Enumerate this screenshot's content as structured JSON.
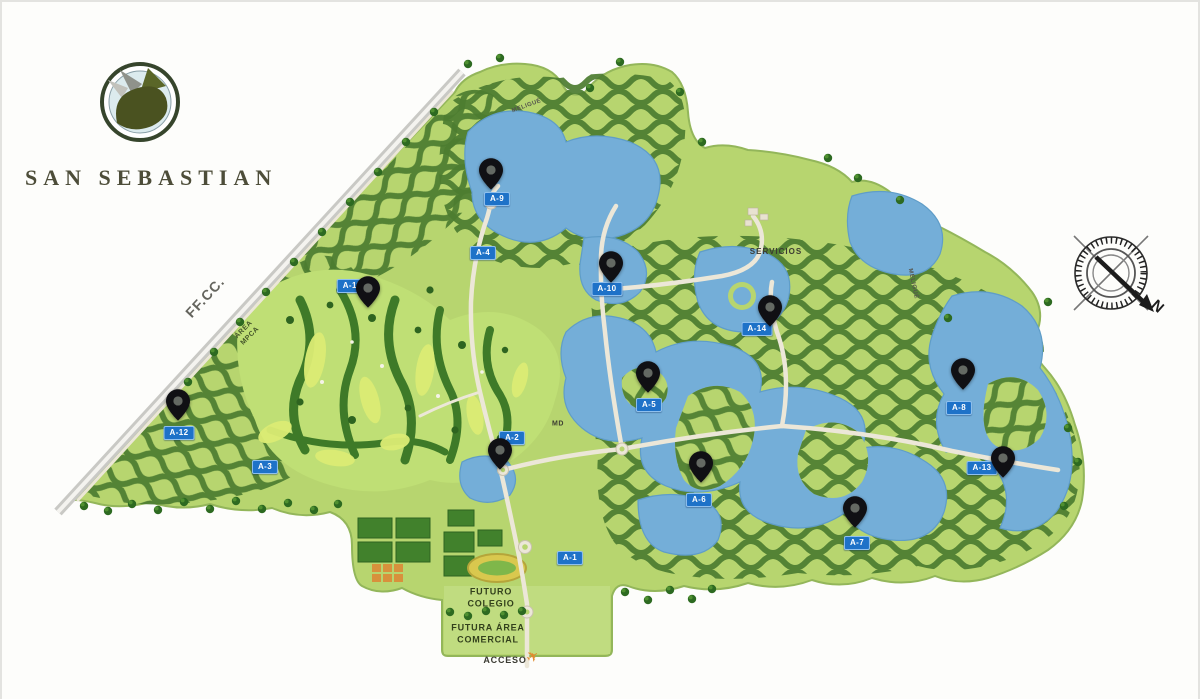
{
  "branding": {
    "title": "SAN SEBASTIAN"
  },
  "compass": {
    "north_label": "N"
  },
  "map": {
    "colors": {
      "label_bg": "#1e72c8",
      "water": "#74aed8",
      "base_green": "#b7d56f",
      "residential_green": "#4c7c30",
      "pin_color": "#101014",
      "road": "#ece7d8"
    },
    "area_labels": [
      {
        "id": "A-9",
        "text": "A-9",
        "x": 497,
        "y": 199
      },
      {
        "id": "A-4",
        "text": "A-4",
        "x": 483,
        "y": 253
      },
      {
        "id": "A-11",
        "text": "A-11",
        "x": 352,
        "y": 286
      },
      {
        "id": "A-10",
        "text": "A-10",
        "x": 607,
        "y": 289
      },
      {
        "id": "A-14",
        "text": "A-14",
        "x": 757,
        "y": 329
      },
      {
        "id": "A-5",
        "text": "A-5",
        "x": 649,
        "y": 405
      },
      {
        "id": "A-12",
        "text": "A-12",
        "x": 179,
        "y": 433
      },
      {
        "id": "A-2",
        "text": "A-2",
        "x": 512,
        "y": 438
      },
      {
        "id": "A-3",
        "text": "A-3",
        "x": 265,
        "y": 467
      },
      {
        "id": "A-8",
        "text": "A-8",
        "x": 959,
        "y": 408
      },
      {
        "id": "A-13",
        "text": "A-13",
        "x": 982,
        "y": 468
      },
      {
        "id": "A-6",
        "text": "A-6",
        "x": 699,
        "y": 500
      },
      {
        "id": "A-7",
        "text": "A-7",
        "x": 857,
        "y": 543
      },
      {
        "id": "A-1",
        "text": "A-1",
        "x": 570,
        "y": 558
      }
    ],
    "pins": [
      {
        "area": "A-9",
        "x": 491,
        "y": 190
      },
      {
        "area": "A-11",
        "x": 368,
        "y": 308
      },
      {
        "area": "A-10",
        "x": 611,
        "y": 283
      },
      {
        "area": "A-14",
        "x": 770,
        "y": 327
      },
      {
        "area": "A-5",
        "x": 648,
        "y": 393
      },
      {
        "area": "A-12",
        "x": 178,
        "y": 421
      },
      {
        "area": "A-2",
        "x": 500,
        "y": 470
      },
      {
        "area": "A-6",
        "x": 701,
        "y": 483
      },
      {
        "area": "A-8",
        "x": 963,
        "y": 390
      },
      {
        "area": "A-13",
        "x": 1003,
        "y": 478
      },
      {
        "area": "A-7",
        "x": 855,
        "y": 528
      }
    ],
    "place_labels": [
      {
        "text": "FF.CC.",
        "x": 205,
        "y": 297,
        "rotate": -47,
        "size": 14,
        "color": "#64645d",
        "spacing": 1
      },
      {
        "text": "ÁREA\nMPCA",
        "x": 247,
        "y": 333,
        "rotate": -45,
        "size": 7,
        "color": "#44552a",
        "spacing": 0.5
      },
      {
        "text": "SERVICIOS",
        "x": 776,
        "y": 252,
        "rotate": 0,
        "size": 8,
        "color": "#3b3b32",
        "spacing": 1
      },
      {
        "text": "MELIGUÉ",
        "x": 527,
        "y": 107,
        "rotate": -20,
        "size": 6,
        "color": "#55554e",
        "spacing": 0.5
      },
      {
        "text": "MELIGUÉ",
        "x": 912,
        "y": 284,
        "rotate": 78,
        "size": 6,
        "color": "#55554e",
        "spacing": 0.5
      },
      {
        "text": "MD",
        "x": 558,
        "y": 424,
        "rotate": 0,
        "size": 7,
        "color": "#3b3b32",
        "spacing": 0.5
      },
      {
        "text": "FUTURO\nCOLEGIO",
        "x": 491,
        "y": 598,
        "rotate": 0,
        "size": 9,
        "color": "#33411c",
        "spacing": 0.8
      },
      {
        "text": "FUTURA ÁREA\nCOMERCIAL",
        "x": 488,
        "y": 634,
        "rotate": 0,
        "size": 9,
        "color": "#33411c",
        "spacing": 0.8
      },
      {
        "text": "ACCESO",
        "x": 505,
        "y": 661,
        "rotate": 0,
        "size": 9,
        "color": "#3b3b32",
        "spacing": 0.8
      }
    ],
    "access_icon": {
      "glyph": "✈",
      "x": 533,
      "y": 657,
      "color": "#e08a2e"
    }
  }
}
